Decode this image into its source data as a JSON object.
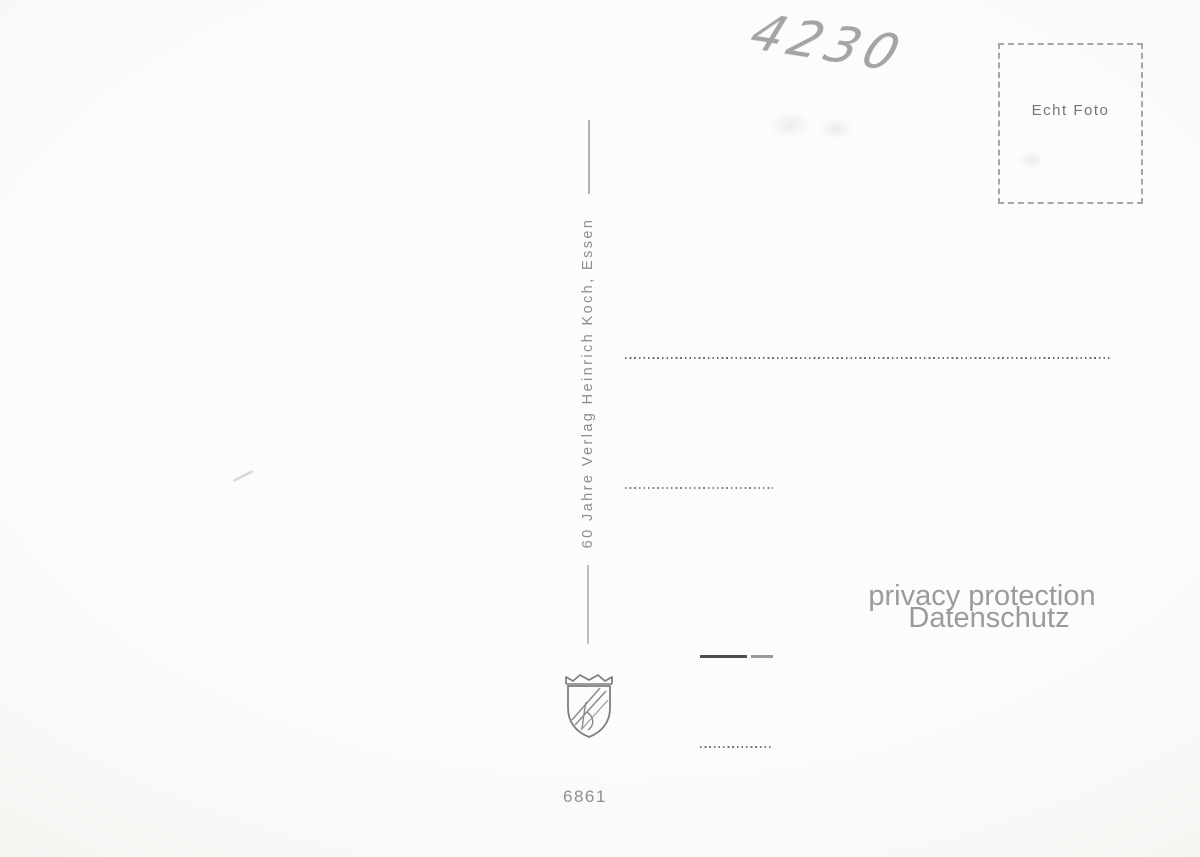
{
  "postcard": {
    "handwritten_code": "4230",
    "stamp": {
      "label": "Echt Foto"
    },
    "publisher_line": "60 Jahre Verlag Heinrich Koch, Essen",
    "serial_number": "6861",
    "watermark": {
      "line1": "privacy protection",
      "line2": "Datenschutz"
    },
    "colors": {
      "paper": "#fbfbfa",
      "print_gray": "#8d8d8d",
      "ink_dark": "#4d4d4d",
      "watermark_gray": "#9b9b9b",
      "pencil_gray": "#a4a4a6"
    }
  }
}
